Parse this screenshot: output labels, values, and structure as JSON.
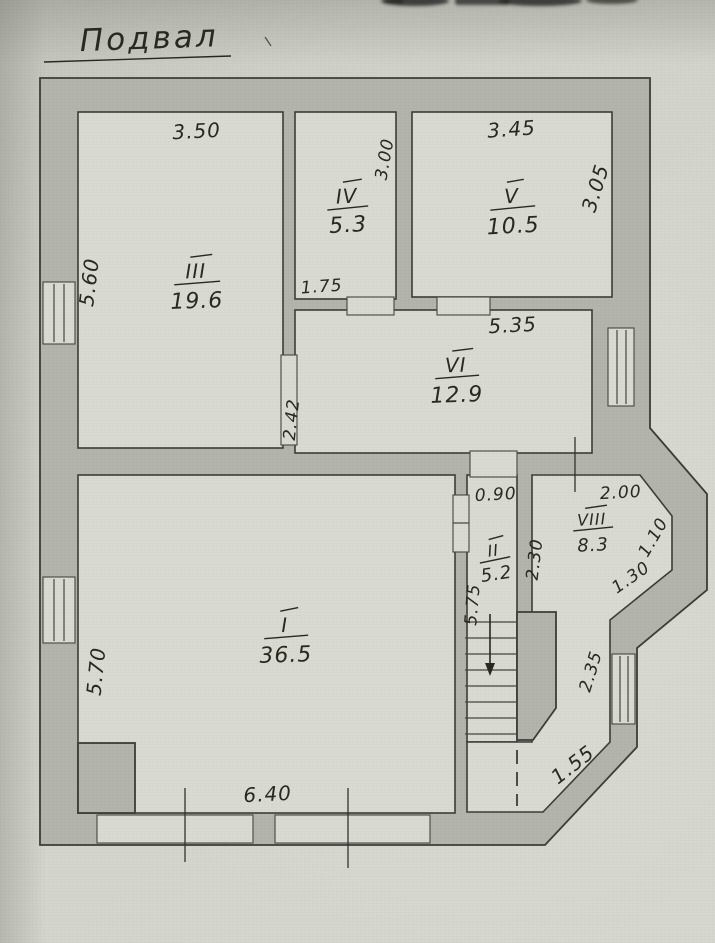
{
  "title": {
    "text": "Подвал"
  },
  "rooms": {
    "r1": {
      "numeral": "I",
      "area": "36.5"
    },
    "r2": {
      "numeral": "II",
      "area": "5.2"
    },
    "r3": {
      "numeral": "III",
      "area": "19.6"
    },
    "r4": {
      "numeral": "IV",
      "area": "5.3"
    },
    "r5": {
      "numeral": "V",
      "area": "10.5"
    },
    "r6": {
      "numeral": "VI",
      "area": "12.9"
    },
    "r8": {
      "numeral": "VIII",
      "area": "8.3"
    }
  },
  "dimensions": {
    "room3_width": "3.50",
    "room3_height": "5.60",
    "room4_height": "3.00",
    "room5_width": "3.45",
    "room5_height": "3.05",
    "room4_bottom": "1.75",
    "room6_width": "5.35",
    "room6_height": "2.42",
    "corridor_width": "0.90",
    "room8_width": "2.00",
    "bay_upper_side": "1.10",
    "lobby_depth": "2.30",
    "bay_lower_side": "1.30",
    "stairs_length": "5.75",
    "room1_height": "5.70",
    "bay_window_height": "2.35",
    "bottom_diagonal": "1.55",
    "room1_width": "6.40"
  },
  "stairs": {
    "direction": "down"
  },
  "colors": {
    "paper": "#d4d6ce",
    "wall_fill": "#b3b5ac",
    "room_fill": "#d9dbd3",
    "ink": "#28281f"
  }
}
